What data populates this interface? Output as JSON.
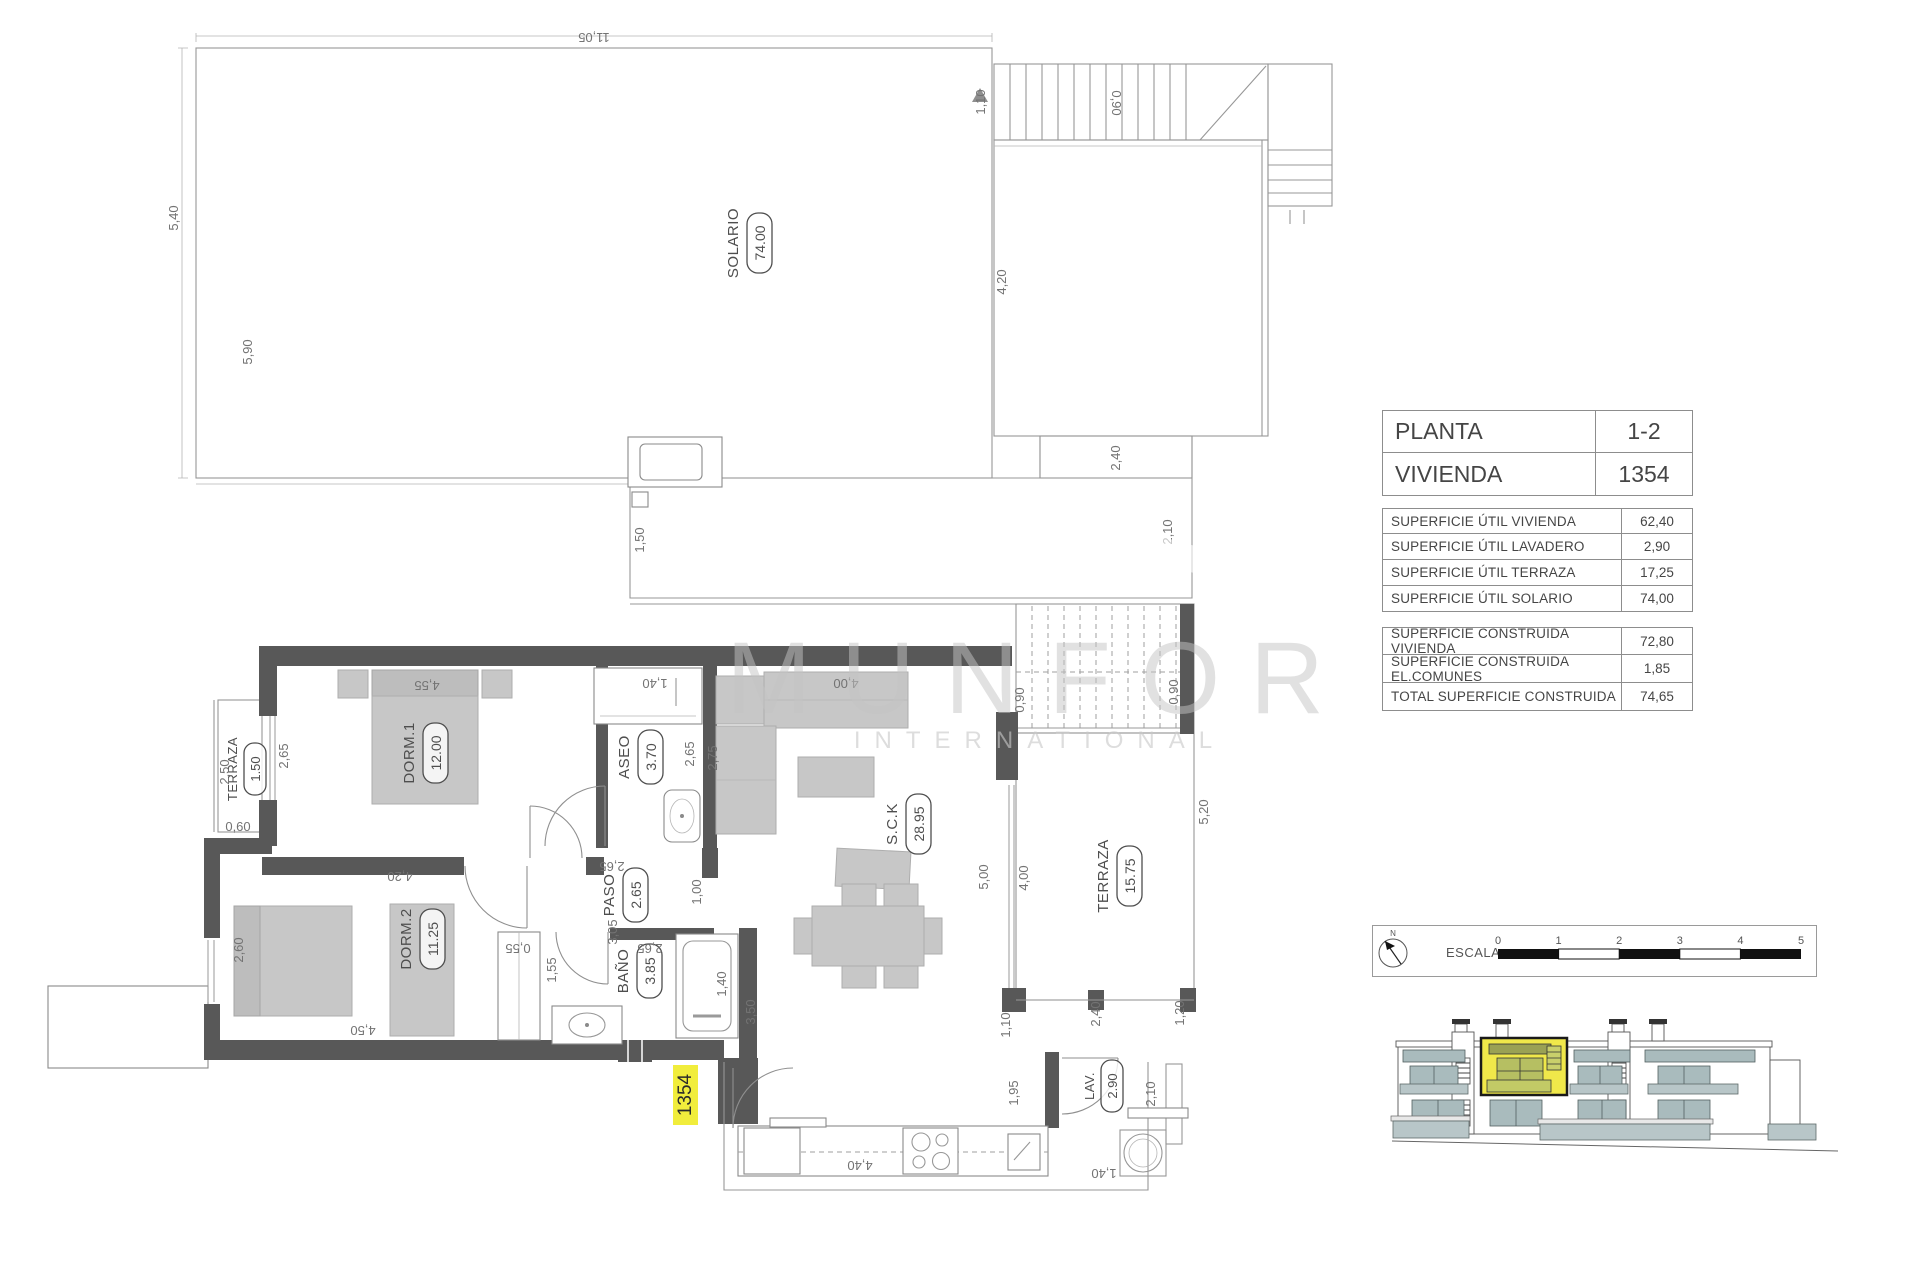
{
  "watermark": {
    "line1": "MUNFOR",
    "line2": "INTERNATIONAL"
  },
  "unit_table": {
    "rows": [
      {
        "label": "PLANTA",
        "value": "1-2"
      },
      {
        "label": "VIVIENDA",
        "value": "1354"
      }
    ]
  },
  "util_table": {
    "rows": [
      {
        "label": "SUPERFICIE  ÚTIL  VIVIENDA",
        "value": "62,40"
      },
      {
        "label": "SUPERFICIE ÚTIL LAVADERO",
        "value": "2,90"
      },
      {
        "label": "SUPERFICIE  ÚTIL  TERRAZA",
        "value": "17,25"
      },
      {
        "label": "SUPERFICIE ÚTIL SOLARIO",
        "value": "74,00"
      }
    ]
  },
  "built_table": {
    "rows": [
      {
        "label": "SUPERFICIE CONSTRUIDA VIVIENDA",
        "value": "72,80"
      },
      {
        "label": "SUPERFICIE CONSTRUIDA EL.COMUNES",
        "value": "1,85"
      },
      {
        "label": "TOTAL SUPERFICIE CONSTRUIDA",
        "value": "74,65"
      }
    ]
  },
  "scale_bar": {
    "label": "ESCALA :",
    "north": "N",
    "ticks": [
      "0",
      "1",
      "2",
      "3",
      "4",
      "5"
    ]
  },
  "rooms": {
    "solario": {
      "name": "SOLARIO",
      "area": "74.00"
    },
    "dorm1": {
      "name": "DORM.1",
      "area": "12.00"
    },
    "dorm2": {
      "name": "DORM.2",
      "area": "11.25"
    },
    "aseo": {
      "name": "ASEO",
      "area": "3.70"
    },
    "paso": {
      "name": "PASO",
      "area": "2.65"
    },
    "bano": {
      "name": "BAÑO",
      "area": "3.85"
    },
    "sck": {
      "name": "S.C.K",
      "area": "28.95"
    },
    "terraza_left": {
      "name": "TERRAZA",
      "area": "1.50"
    },
    "terraza_right": {
      "name": "TERRAZA",
      "area": "15.75"
    },
    "lav": {
      "name": "LAV.",
      "area": "2.90"
    }
  },
  "unit_tag": "1354",
  "dims": {
    "solario_top": "11,05",
    "solario_left_upper": "5,40",
    "solario_left_lower": "5,90",
    "solario_ext_left": "1,50",
    "solario_stair_h": "1,10",
    "solario_stair_w": "0,90",
    "court_right": "4,20",
    "court_b1": "2,40",
    "court_b2": "2,10",
    "dorm1_top": "4,55",
    "dorm1_left": "2,65",
    "terraza_l_h": "2,50",
    "terraza_l_b": "0,60",
    "dorm1_bottom": "4,20",
    "dorm2_left": "2,60",
    "dorm2_bottom": "4,50",
    "aseo_closet": "1,40",
    "aseo_right": "2,65",
    "paso_w": "2,65",
    "paso_l": "3,05",
    "bano_w": "2,65",
    "closet_w": "0,55",
    "bano_left": "1,55",
    "tub_l": "1,40",
    "bano_right": "3,50",
    "sck_top": "4,00",
    "sck_left": "2,75",
    "sck_opening": "1,00",
    "terraza_r_5": "5,00",
    "terraza_r_4": "4,00",
    "stairs_l": "0,90",
    "stairs_r": "0,90",
    "terraza_r_right": "5,20",
    "terraza_r_b1": "2,40",
    "terraza_r_b2": "1,20",
    "terraza_r_b3": "1,10",
    "kitchen_w": "4,40",
    "kitchen_h": "1,95",
    "lav_h": "2,10",
    "lav_w": "1,40"
  }
}
